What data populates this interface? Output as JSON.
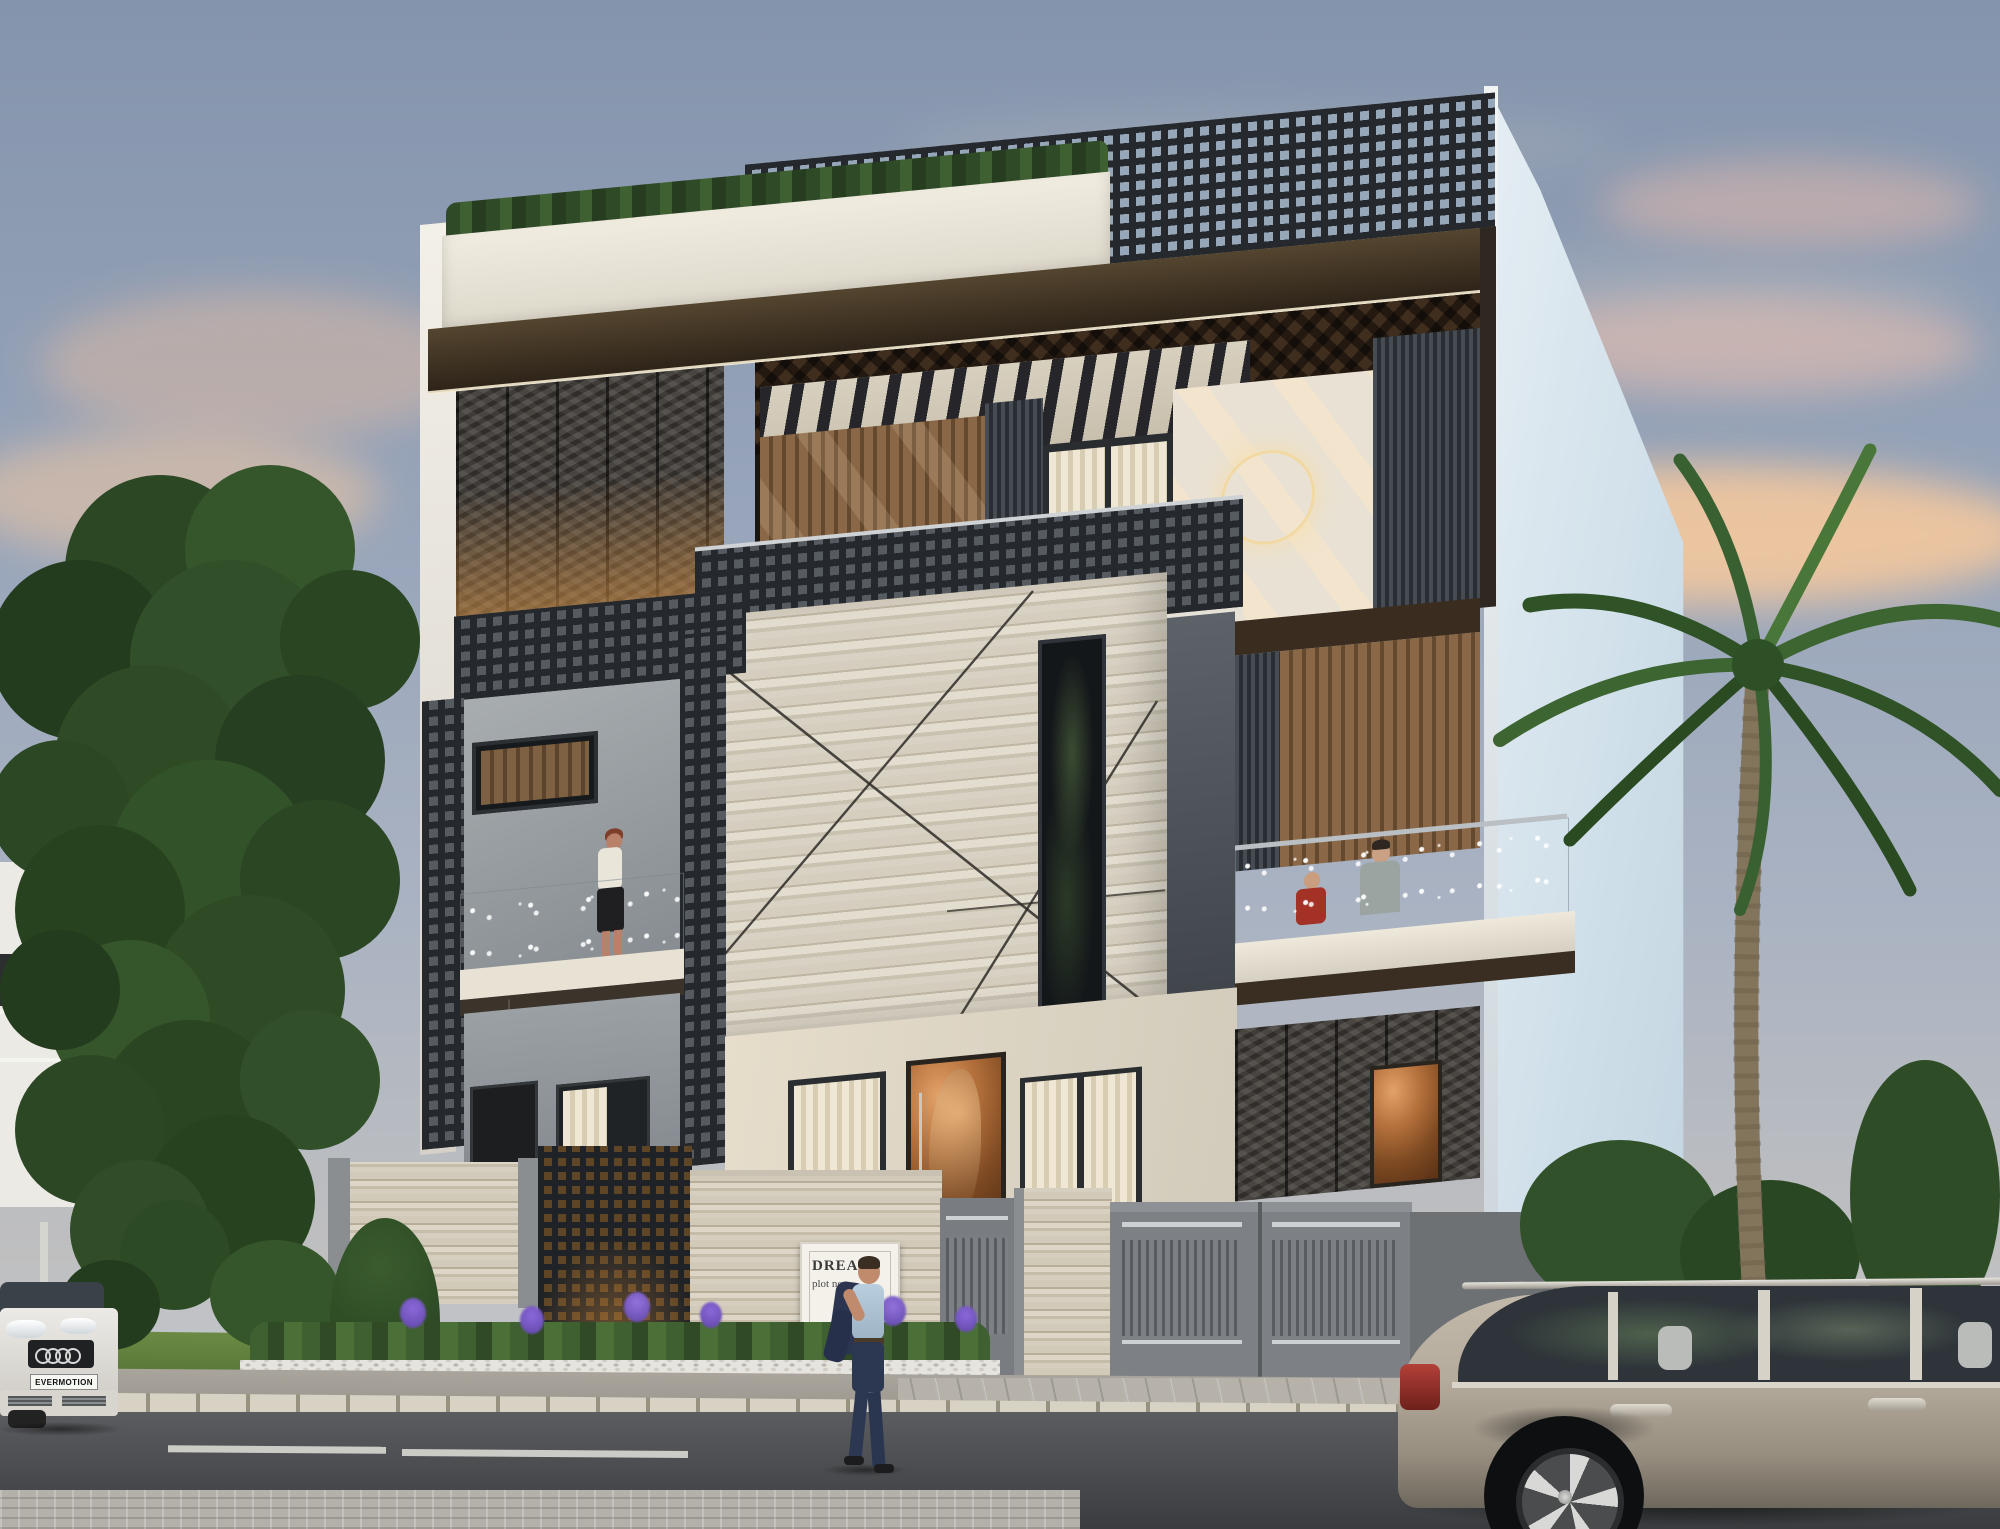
{
  "image": {
    "kind": "3d-architectural-exterior-render",
    "subject": "modern three-storey villa, street elevation at dusk",
    "weather": "clear dusk sky with pink-orange clouds"
  },
  "signboard": {
    "line1": "DREAM",
    "line2": "plot no-"
  },
  "vehicles": {
    "left_car": {
      "view": "front, partially cropped",
      "body_color": "#e8e7e3",
      "left_car_plate": "EVERMOTION"
    },
    "right_car": {
      "view": "side, partially cropped",
      "body_color": "#b5ab9c"
    }
  },
  "people": {
    "sidewalk_man": "man in navy suit carrying jacket over shoulder",
    "first_floor_balcony_woman": "woman in white top and black skirt behind glass railing",
    "second_floor_balcony_pair": "adult in gray shirt and child in red shirt behind glass railing"
  },
  "building": {
    "storeys": 3,
    "features": [
      "perforated metal screen crown",
      "rooftop hedge planter",
      "bronze frame",
      "wood slat walls",
      "travertine marble volume with diagonal seams",
      "ring wall light",
      "copper art doors",
      "black jali portal",
      "glass balconies"
    ]
  },
  "landscape": {
    "left": "large deciduous trees and white neighbour house",
    "right": "tall palm tree and pink flowering shrubs",
    "front": "planter bed with purple irises, white pebbles, conifer and lawn"
  },
  "street": {
    "elements": [
      "stone curb",
      "paved driveway apron",
      "asphalt road with white lane dashes",
      "herringbone paver strip"
    ]
  },
  "palette": {
    "sky_top": "#8795ad",
    "sky_cloud_orange": "#f2c49c",
    "facade_white": "#ece8dd",
    "bronze_frame": "#3f3428",
    "marble": "#d5cebf",
    "mesh_dark": "#25282d",
    "wood_slat": "#8a6847",
    "copper_door": "#b5713c",
    "stucco": "#ded7c8",
    "road": "#46484b",
    "lawn": "#5d7d3c",
    "palm_green": "#3f6b33",
    "glass": "#cfe2ea",
    "side_wall": "#d9e6ee",
    "gate_gray": "#7d8084",
    "ring_light": "#f2d9a4"
  }
}
